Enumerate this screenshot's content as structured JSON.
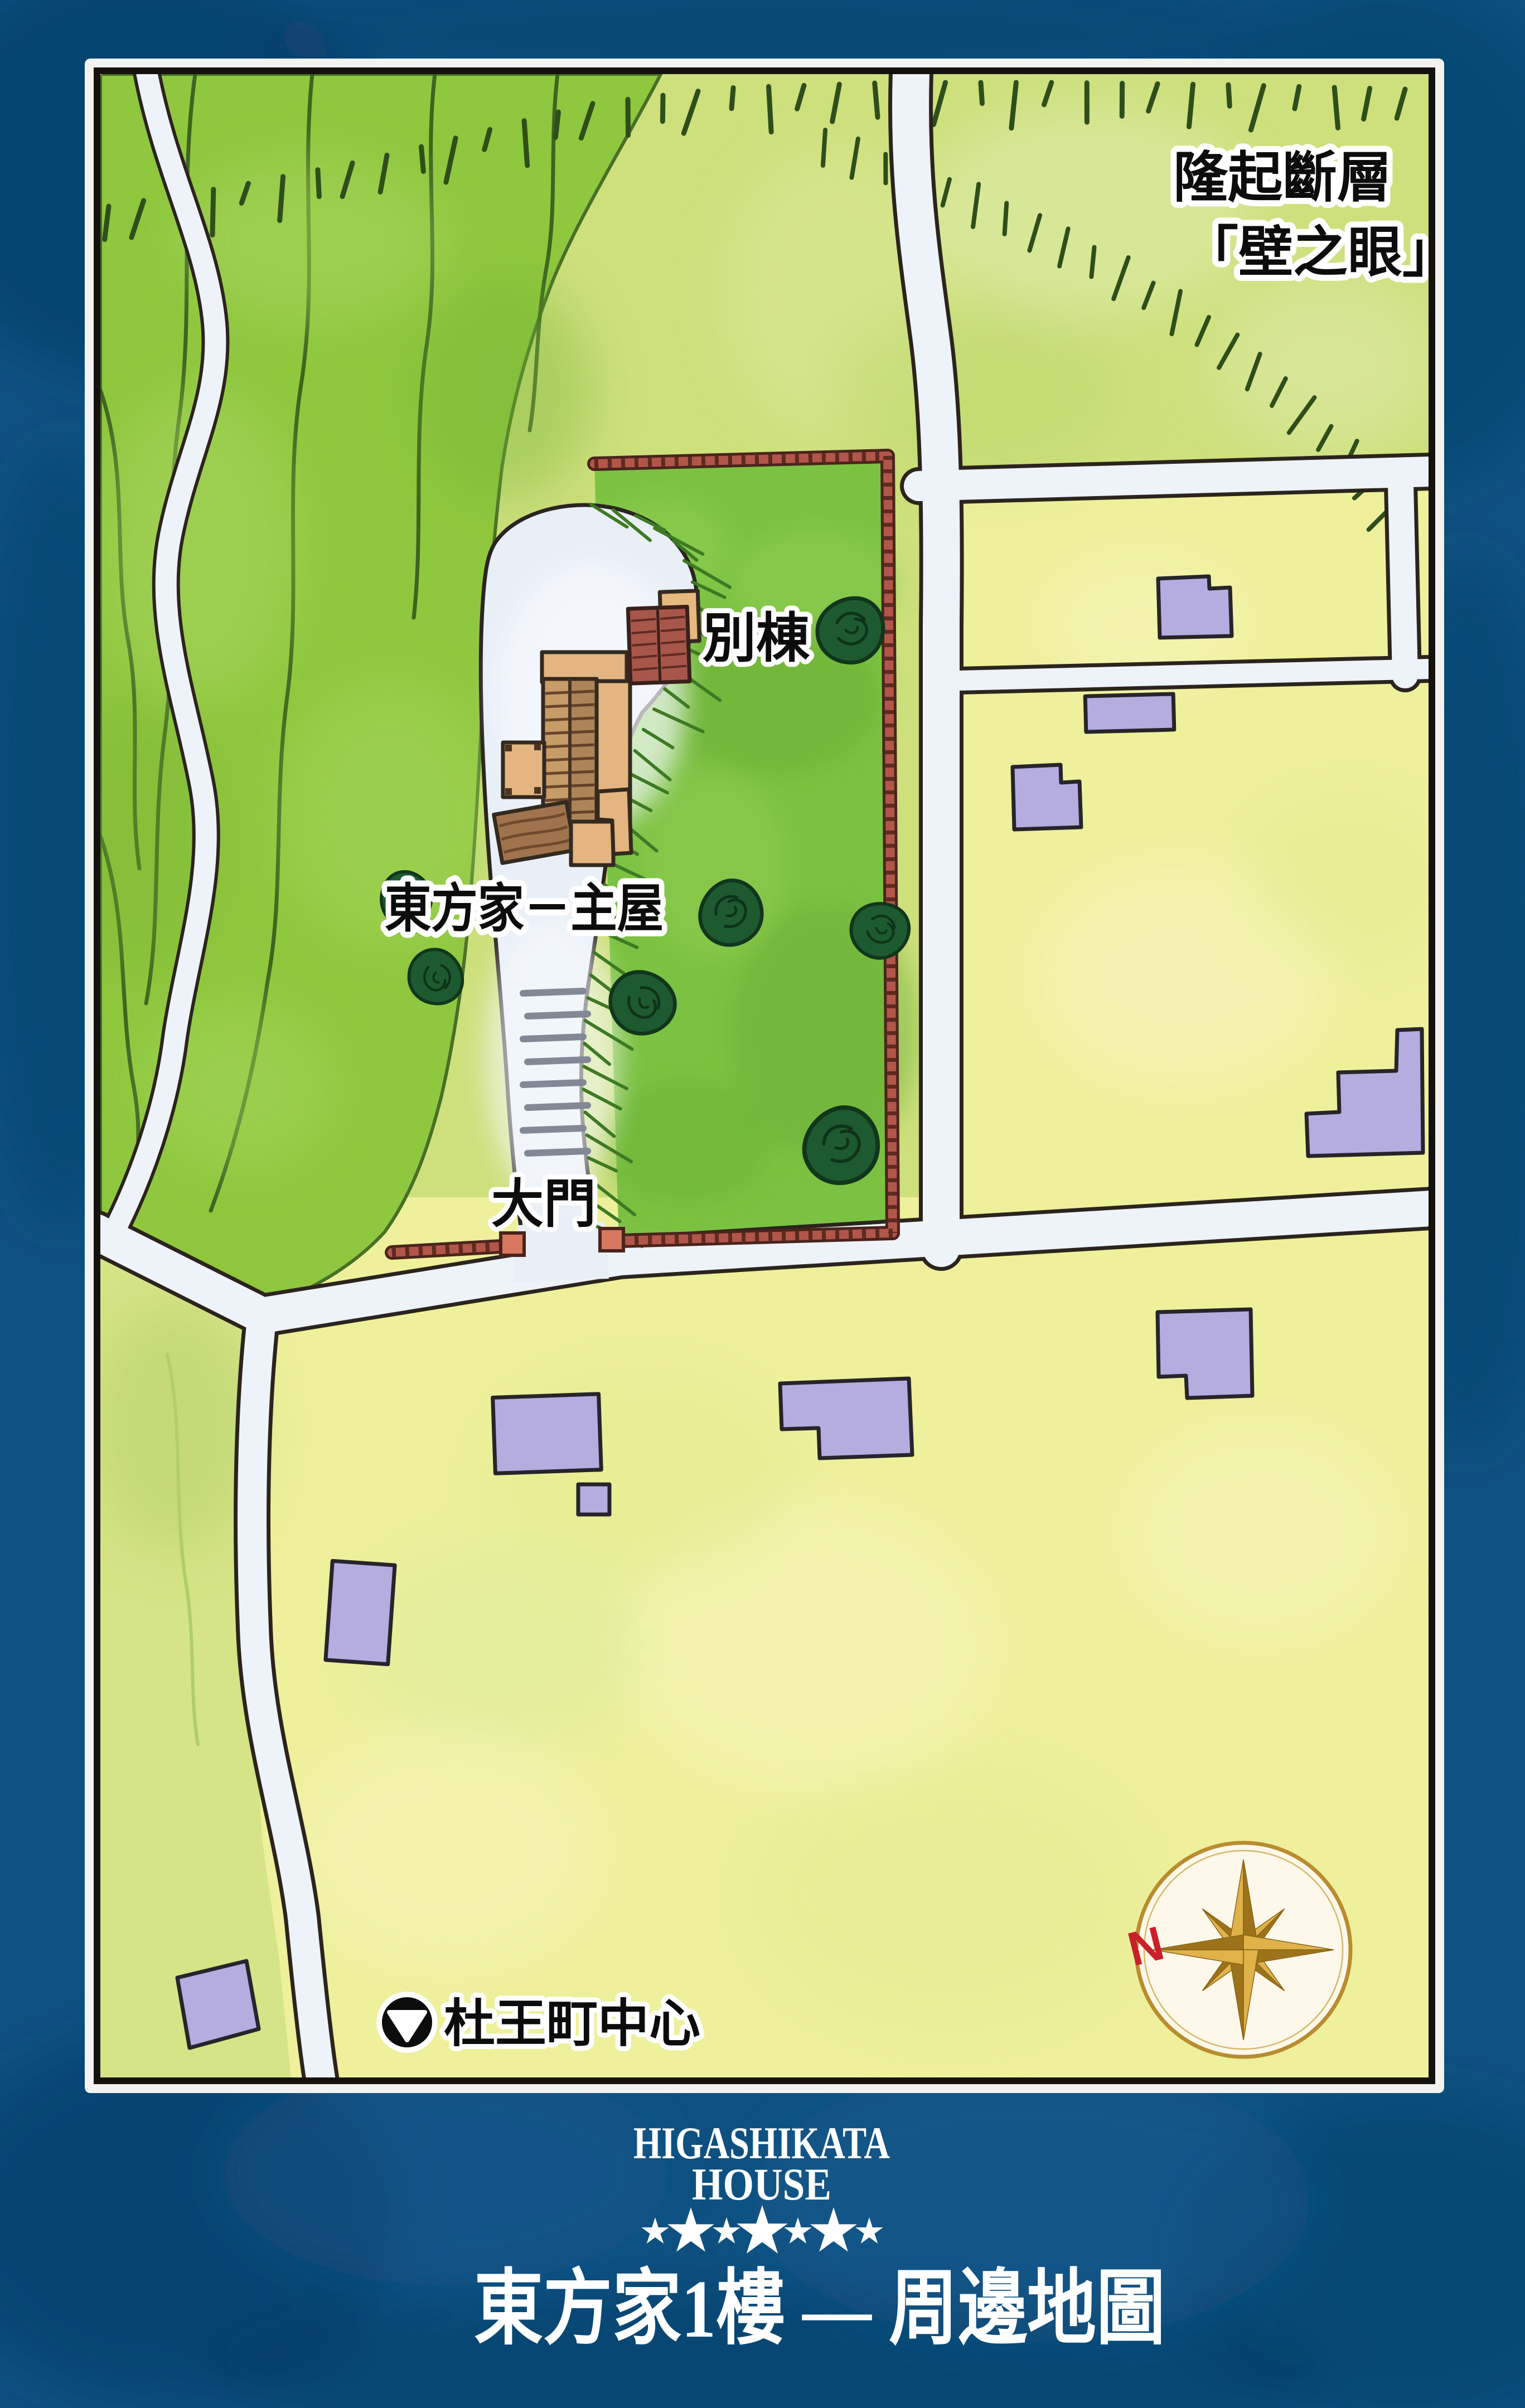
{
  "map": {
    "labels": {
      "fault_name": "隆起斷層",
      "fault_name_quoted": "「壁之眼」",
      "annex": "別棟",
      "main_house": "東方家－主屋",
      "main_gate": "大門",
      "town_center": "杜王町中心"
    },
    "town_center_icon": "▼",
    "compass": {
      "north": "N"
    },
    "colors": {
      "background_blue": "#0f5181",
      "hill_green": "#8fc73e",
      "fault_zone_green": "#cde07c",
      "estate_lawn_green": "#7cc242",
      "field_yellow": "#eef09b",
      "building_purple": "#b5addf",
      "fence_red": "#b2564a",
      "roof_tan": "#e4b581",
      "annex_roof_red": "#a8564a",
      "tree_green": "#1d5a30",
      "road_white": "#eef2f9",
      "compass_gold": "#c0912f",
      "north_red": "#c9202c"
    }
  },
  "footer": {
    "logo_line1": "HIGASHIKATA",
    "logo_line2": "HOUSE",
    "stars": 7,
    "title": "東方家1樓 — 周邊地圖"
  }
}
